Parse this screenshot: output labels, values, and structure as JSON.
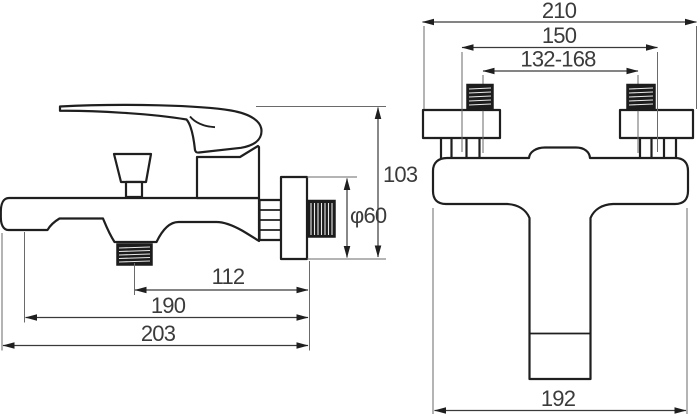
{
  "drawing": {
    "background": "#ffffff",
    "line_color": "#1f1f1f",
    "dimension_text_color": "#3b3b3b",
    "views": {
      "side": {
        "dimensions": {
          "outlet_to_wall": "112",
          "spout_to_wall": "190",
          "overall_depth": "203",
          "overall_height": "103",
          "flange_diameter": "φ60"
        }
      },
      "front": {
        "dimensions": {
          "overall_width": "210",
          "union_spacing": "150",
          "adjustment_range": "132-168",
          "body_width": "192"
        }
      }
    }
  }
}
